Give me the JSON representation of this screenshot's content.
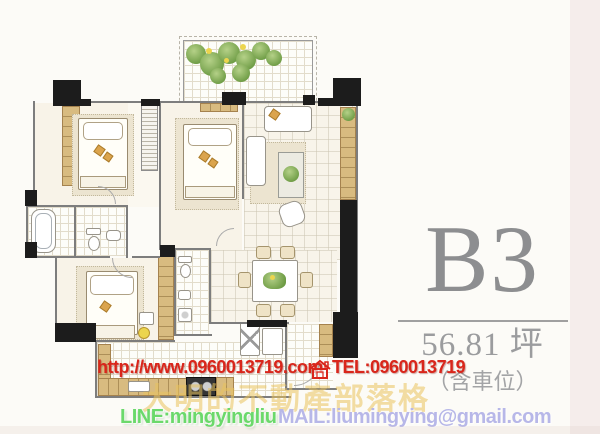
{
  "panel": {
    "unit_label": "B3",
    "area_label": "56.81 坪",
    "parking_label": "（含車位）"
  },
  "watermark": {
    "url": "http://www.0960013719.com",
    "tel": "TEL:0960013719",
    "blog": "大明的不動產部落格",
    "line": "LINE:mingyingliu",
    "mail": "MAIL:liumingying@gmail.com"
  },
  "colors": {
    "unit_text": "#8d8e90",
    "watermark_red": "#d9261b",
    "watermark_green": "#6bd96b",
    "watermark_purple": "#b7b7e8",
    "watermark_yellow": "rgba(233,194,92,0.55)",
    "wall_black": "#1c1c1c",
    "cabinet_wood": "#d8bb80",
    "plant_green": "#6e9c45"
  }
}
